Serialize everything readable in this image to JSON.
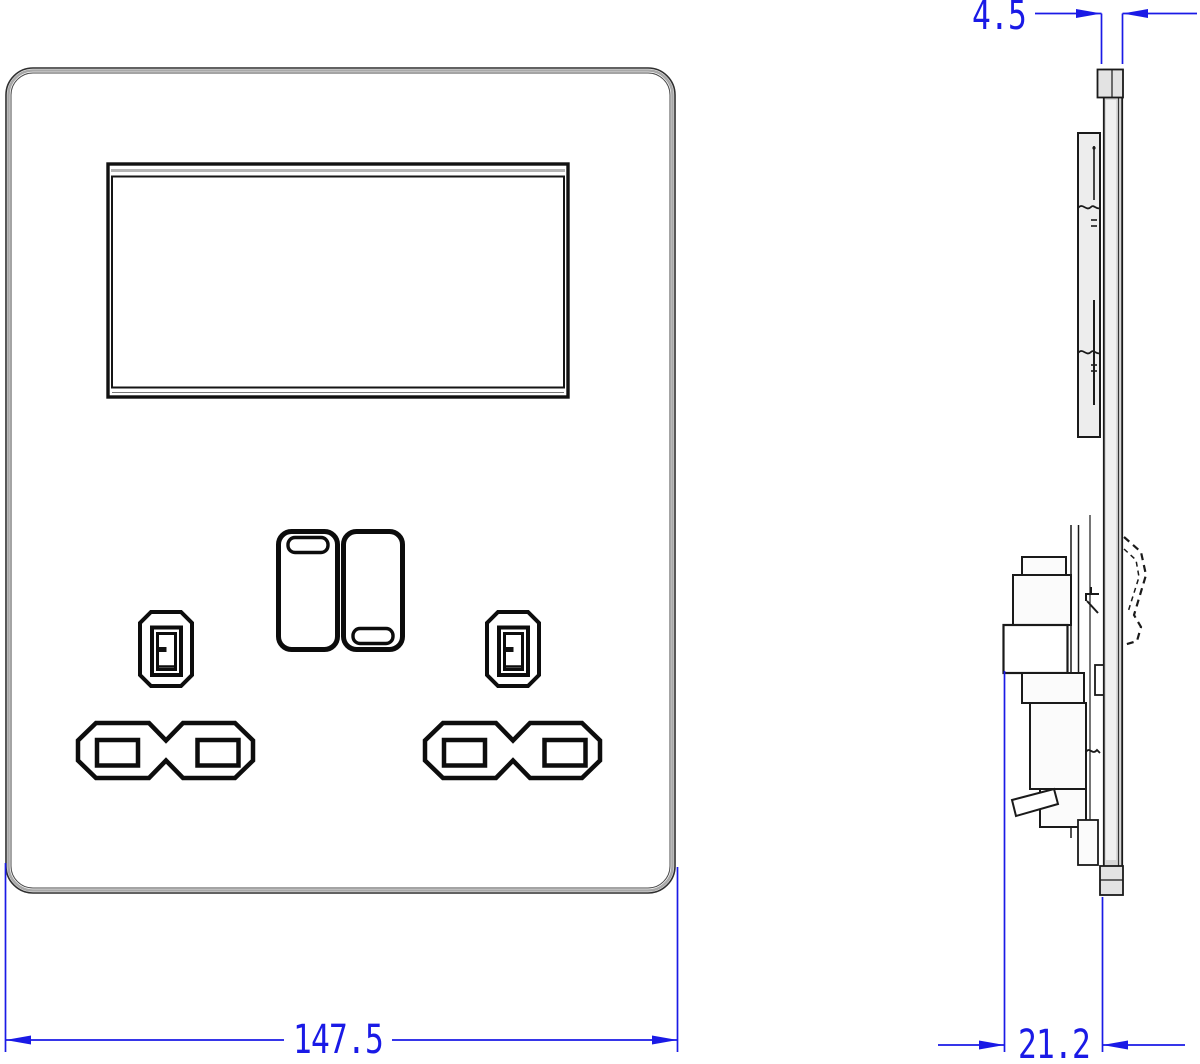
{
  "drawing": {
    "type": "cad_technical_drawing",
    "views": [
      "front-view",
      "side-view"
    ],
    "components": {
      "front_view": [
        "faceplate",
        "display-window",
        "rocker-switch-left",
        "rocker-switch-right",
        "earth-pin-aperture-left",
        "earth-pin-aperture-right",
        "live-neutral-aperture-left",
        "live-neutral-aperture-right"
      ],
      "side_view": [
        "faceplate-profile",
        "display-module-profile",
        "socket-mechanism-profile",
        "rocker-switch-profile-hidden-line"
      ]
    }
  },
  "dimensions": {
    "plate_thickness": "4.5",
    "plate_width": "147.5",
    "mechanism_depth": "21.2"
  },
  "colors": {
    "dimension_blue": "#1a1ae6",
    "line_black": "#1a1a1a",
    "edge_gray": "#a8a8a8",
    "plate_fill": "#d7d7d7"
  }
}
